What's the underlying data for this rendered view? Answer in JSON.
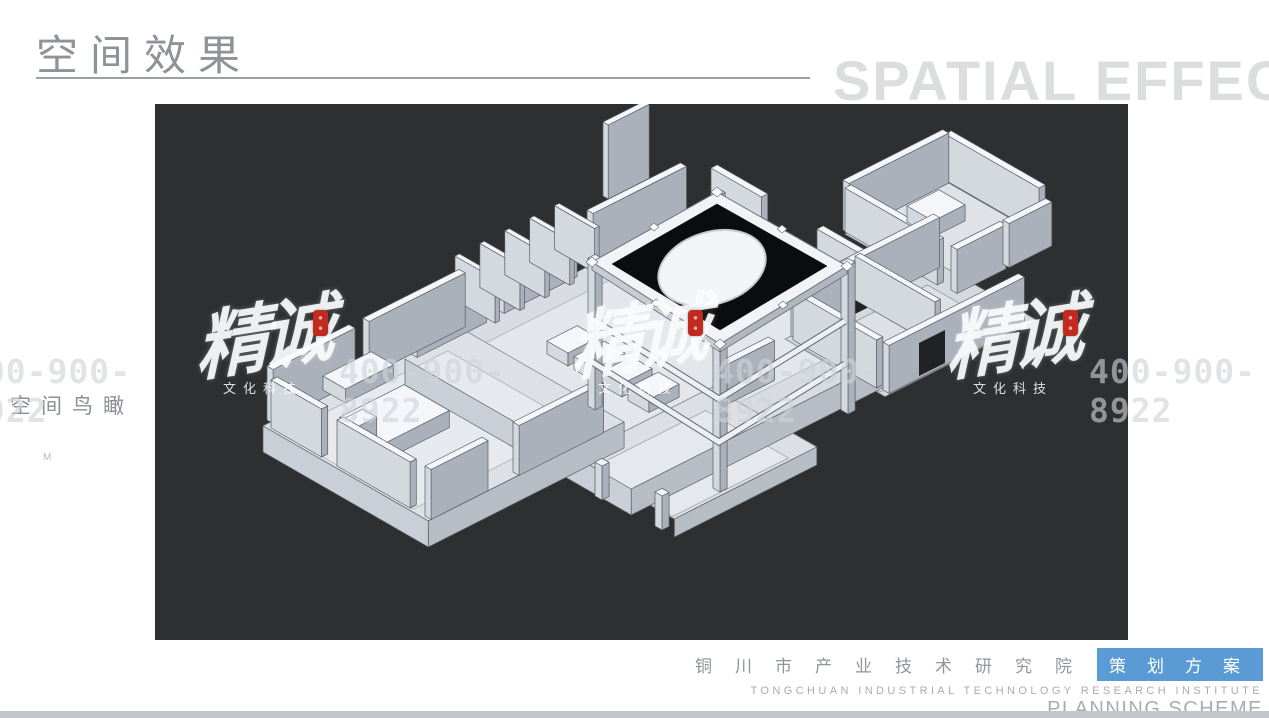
{
  "header": {
    "title_cn": "空间效果",
    "title_en": "SPATIAL EFFECT"
  },
  "view_label": {
    "text": "空间鸟瞰",
    "note": "M"
  },
  "watermark": {
    "brand": "精诚",
    "brand_sub": "文化科技",
    "phone": "400-900-8922"
  },
  "footer": {
    "org_cn": "铜川市产业技术研究院",
    "badge": "策划方案",
    "org_en": "TONGCHUAN INDUSTRIAL TECHNOLOGY RESEARCH INSTITUTE",
    "plan_en": "PLANNING SCHEME"
  },
  "colors": {
    "accent_blue": "#5b9bd5",
    "canvas_dark": "#2e2f31",
    "bottom_bar": "#c3c7cb",
    "seal_red": "#c22a20",
    "title_gray": "#8e9398"
  }
}
